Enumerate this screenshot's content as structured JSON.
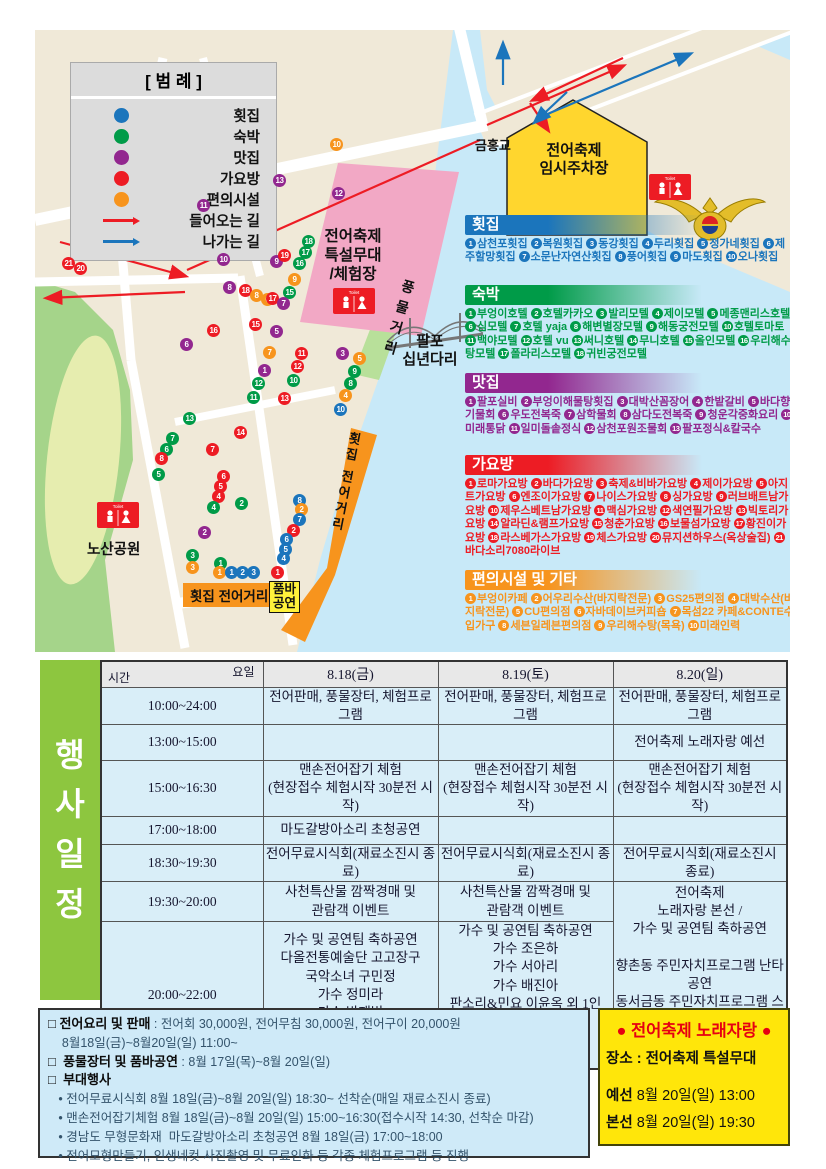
{
  "legend": {
    "title": "[ 범 례 ]",
    "items": [
      {
        "label": "횟집",
        "color": "#1b75bc"
      },
      {
        "label": "숙박",
        "color": "#009b48"
      },
      {
        "label": "맛집",
        "color": "#92278f"
      },
      {
        "label": "가요방",
        "color": "#ed1c24"
      },
      {
        "label": "편의시설",
        "color": "#f7941d"
      }
    ],
    "arrows": [
      {
        "label": "들어오는 길",
        "color": "#ed1c24"
      },
      {
        "label": "나가는 길",
        "color": "#1b75bc"
      }
    ]
  },
  "map": {
    "labels": {
      "bridge_top": "금홍교",
      "parking": "전어축제\n임시주차장",
      "stage": "전어축제\n특설무대\n/체험장",
      "pungmul": "풍물거리",
      "bridge": "팔포\n십년다리",
      "park": "노산공원",
      "fish_street": "횟집 전어거리",
      "fish_street_v": "횟집 전어거리",
      "pumba": "품바\n공연",
      "toilet": "Toilet"
    },
    "dots": [
      {
        "c": "r",
        "n": 21,
        "x": 27,
        "y": 227
      },
      {
        "c": "r",
        "n": 20,
        "x": 39,
        "y": 232
      },
      {
        "c": "p",
        "n": 13,
        "x": 238,
        "y": 144
      },
      {
        "c": "o",
        "n": 10,
        "x": 295,
        "y": 108
      },
      {
        "c": "p",
        "n": 12,
        "x": 297,
        "y": 157
      },
      {
        "c": "p",
        "n": 11,
        "x": 162,
        "y": 169
      },
      {
        "c": "p",
        "n": 10,
        "x": 182,
        "y": 223
      },
      {
        "c": "p",
        "n": 9,
        "x": 235,
        "y": 225
      },
      {
        "c": "r",
        "n": 19,
        "x": 243,
        "y": 219
      },
      {
        "c": "g",
        "n": 18,
        "x": 267,
        "y": 205
      },
      {
        "c": "g",
        "n": 17,
        "x": 264,
        "y": 216
      },
      {
        "c": "g",
        "n": 16,
        "x": 258,
        "y": 227
      },
      {
        "c": "o",
        "n": 9,
        "x": 253,
        "y": 243
      },
      {
        "c": "p",
        "n": 8,
        "x": 188,
        "y": 251
      },
      {
        "c": "r",
        "n": 18,
        "x": 204,
        "y": 254
      },
      {
        "c": "o",
        "n": 8,
        "x": 215,
        "y": 259
      },
      {
        "c": "o",
        "n": 6,
        "x": 226,
        "y": 263
      },
      {
        "c": "g",
        "n": 15,
        "x": 248,
        "y": 256
      },
      {
        "c": "r",
        "n": 17,
        "x": 231,
        "y": 262
      },
      {
        "c": "p",
        "n": 7,
        "x": 242,
        "y": 267
      },
      {
        "c": "r",
        "n": 16,
        "x": 172,
        "y": 294
      },
      {
        "c": "r",
        "n": 15,
        "x": 214,
        "y": 288
      },
      {
        "c": "p",
        "n": 5,
        "x": 235,
        "y": 295
      },
      {
        "c": "o",
        "n": 7,
        "x": 228,
        "y": 316
      },
      {
        "c": "p",
        "n": 6,
        "x": 145,
        "y": 308
      },
      {
        "c": "r",
        "n": 11,
        "x": 260,
        "y": 317
      },
      {
        "c": "r",
        "n": 12,
        "x": 256,
        "y": 330
      },
      {
        "c": "p",
        "n": 1,
        "x": 223,
        "y": 334
      },
      {
        "c": "g",
        "n": 12,
        "x": 217,
        "y": 347
      },
      {
        "c": "g",
        "n": 10,
        "x": 252,
        "y": 344
      },
      {
        "c": "g",
        "n": 11,
        "x": 212,
        "y": 361
      },
      {
        "c": "r",
        "n": 13,
        "x": 243,
        "y": 362
      },
      {
        "c": "g",
        "n": 13,
        "x": 148,
        "y": 382
      },
      {
        "c": "r",
        "n": 14,
        "x": 199,
        "y": 396
      },
      {
        "c": "g",
        "n": 7,
        "x": 131,
        "y": 402
      },
      {
        "c": "g",
        "n": 6,
        "x": 125,
        "y": 413
      },
      {
        "c": "r",
        "n": 8,
        "x": 120,
        "y": 422
      },
      {
        "c": "r",
        "n": 7,
        "x": 171,
        "y": 413
      },
      {
        "c": "g",
        "n": 5,
        "x": 117,
        "y": 438
      },
      {
        "c": "r",
        "n": 6,
        "x": 182,
        "y": 440
      },
      {
        "c": "r",
        "n": 5,
        "x": 179,
        "y": 450
      },
      {
        "c": "r",
        "n": 4,
        "x": 177,
        "y": 460
      },
      {
        "c": "g",
        "n": 4,
        "x": 172,
        "y": 471
      },
      {
        "c": "p",
        "n": 2,
        "x": 163,
        "y": 496
      },
      {
        "c": "g",
        "n": 3,
        "x": 151,
        "y": 519
      },
      {
        "c": "p",
        "n": 3,
        "x": 301,
        "y": 317
      },
      {
        "c": "o",
        "n": 5,
        "x": 318,
        "y": 322
      },
      {
        "c": "g",
        "n": 9,
        "x": 313,
        "y": 335
      },
      {
        "c": "g",
        "n": 8,
        "x": 309,
        "y": 347
      },
      {
        "c": "o",
        "n": 4,
        "x": 304,
        "y": 359
      },
      {
        "c": "b",
        "n": 10,
        "x": 299,
        "y": 373
      },
      {
        "c": "g",
        "n": 2,
        "x": 200,
        "y": 467
      },
      {
        "c": "b",
        "n": 8,
        "x": 258,
        "y": 464
      },
      {
        "c": "o",
        "n": 2,
        "x": 260,
        "y": 473
      },
      {
        "c": "b",
        "n": 7,
        "x": 258,
        "y": 483
      },
      {
        "c": "r",
        "n": 2,
        "x": 252,
        "y": 494
      },
      {
        "c": "b",
        "n": 6,
        "x": 245,
        "y": 503
      },
      {
        "c": "b",
        "n": 5,
        "x": 244,
        "y": 513
      },
      {
        "c": "b",
        "n": 4,
        "x": 242,
        "y": 522
      },
      {
        "c": "o",
        "n": 3,
        "x": 151,
        "y": 531
      },
      {
        "c": "g",
        "n": 1,
        "x": 179,
        "y": 527
      },
      {
        "c": "o",
        "n": 1,
        "x": 178,
        "y": 536
      },
      {
        "c": "b",
        "n": 1,
        "x": 190,
        "y": 536
      },
      {
        "c": "b",
        "n": 2,
        "x": 201,
        "y": 536
      },
      {
        "c": "b",
        "n": 3,
        "x": 212,
        "y": 536
      },
      {
        "c": "r",
        "n": 1,
        "x": 236,
        "y": 536
      }
    ]
  },
  "directory": {
    "sections": [
      {
        "key": "hoejip",
        "title": "횟집",
        "color": "#1b75bc",
        "items": [
          "삼천포횟집",
          "복원횟집",
          "동강횟집",
          "두리횟집",
          "정가네횟집",
          "제주할망횟집",
          "소문난자연산횟집",
          "풍어횟집",
          "마도횟집",
          "오나횟집"
        ]
      },
      {
        "key": "sukbak",
        "title": "숙박",
        "color": "#009b48",
        "items": [
          "부엉이호텔",
          "호텔카카오",
          "발리모텔",
          "제이모텔",
          "메종맨리스호텔",
          "심모텔",
          "호텔 yaja",
          "해변별장모텔",
          "해동궁전모텔",
          "호텔토마토",
          "백야모텔",
          "호텔 vu",
          "써니호텔",
          "무니호텔",
          "올인모텔",
          "우리해수탕모텔",
          "폴라리스모텔",
          "귀빈궁전모텔"
        ]
      },
      {
        "key": "matjip",
        "title": "맛집",
        "color": "#92278f",
        "items": [
          "팔포실비",
          "부엉이해물탕횟집",
          "대박산꼼장어",
          "한밭갈비",
          "바다향기물회",
          "우도전복죽",
          "삼학물회",
          "삼다도전복죽",
          "청운각중화요리",
          "미래통닭",
          "일미돌솥정식",
          "삼천포원조물회",
          "팔포정식&칼국수"
        ]
      },
      {
        "key": "gayobang",
        "title": "가요방",
        "color": "#ed1c24",
        "items": [
          "로마가요방",
          "바다가요방",
          "축제&비바가요방",
          "제이가요방",
          "아지트가요방",
          "엔조이가요방",
          "나이스가요방",
          "싱가요방",
          "러브배트남가요방",
          "제우스베트남가요방",
          "맥심가요방",
          "색연필가요방",
          "빅토리가요방",
          "알라딘&램프가요방",
          "청춘가요방",
          "보물섬가요방",
          "황진이가요방",
          "라스베가스가요방",
          "체스가요방",
          "뮤지션하우스(옥상술집)",
          "바다소리7080라이브"
        ]
      },
      {
        "key": "pyeonui",
        "title": "편의시설 및 기타",
        "color": "#f7941d",
        "items": [
          "부엉이카페",
          "어우리수산(바지락전문)",
          "GS25편의점",
          "대박수산(바지락전문)",
          "CU편의점",
          "자바데이브커피숍",
          "목섬22 카페&CONTE수입가구",
          "세븐일레븐편의점",
          "우리해수탕(목욕)",
          "미래인력"
        ]
      }
    ]
  },
  "schedule": {
    "side_label": "행\n사\n일\n정",
    "corner_day": "요일",
    "corner_time": "시간",
    "days": [
      "8.18(금)",
      "8.19(토)",
      "8.20(일)"
    ],
    "rows": [
      {
        "time": "10:00~24:00",
        "fri": "전어판매, 풍물장터, 체험프로그램",
        "sat": "전어판매, 풍물장터, 체험프로그램",
        "sun": "전어판매, 풍물장터, 체험프로그램"
      },
      {
        "time": "13:00~15:00",
        "fri": "",
        "sat": "",
        "sun": "전어축제 노래자랑 예선"
      },
      {
        "time": "15:00~16:30",
        "fri": "맨손전어잡기 체험\n(현장접수 체험시작 30분전 시작)",
        "sat": "맨손전어잡기 체험\n(현장접수 체험시작 30분전 시작)",
        "sun": "맨손전어잡기 체험\n(현장접수 체험시작 30분전 시작)"
      },
      {
        "time": "17:00~18:00",
        "fri": "마도갈방아소리 초청공연",
        "sat": "",
        "sun": ""
      },
      {
        "time": "18:30~19:30",
        "fri": "전어무료시식회(재료소진시 종료)",
        "sat": "전어무료시식회(재료소진시 종료)",
        "sun": "전어무료시식회(재료소진시 종료)"
      },
      {
        "time": "19:30~20:00",
        "fri": "사천특산물 깜짝경매 및\n관람객 이벤트",
        "sat": "사천특산물 깜짝경매 및\n관람객 이벤트",
        "sun": "전어축제\n노래자랑 본선 /\n가수 및 공연팀 축하공연\n\n향촌동 주민자치프로그램 난타공연\n동서금동 주민자치프로그램 스포츠댄스\n가수 백프로\n댄스팀 레트로"
      },
      {
        "time": "20:00~22:00",
        "fri": "가수 및 공연팀 축하공연\n다올전통예술단 고고장구\n국악소녀 구민정\n가수 정미라\n가수 박재범\n가수 한별이\n품바여신 버드리",
        "sat": "가수 및 공연팀 축하공연\n가수 조은하\n가수 서아리\n가수 배진아\n판소리&민요 이윤옥 외 1인\n가수 문수화\n가수 김혜진\n가수 유진표"
      }
    ]
  },
  "info": {
    "lines": [
      {
        "h": "□ 전어요리 및 판매",
        "t": " : 전어회 30,000원, 전어무침 30,000원, 전어구이 20,000원"
      },
      {
        "h": "",
        "t": "    8월18일(금)~8월20일(일) 11:00~"
      },
      {
        "h": "□  풍물장터 및 품바공연",
        "t": " : 8월 17일(목)~8월 20일(일)"
      },
      {
        "h": "□  부대행사",
        "t": ""
      },
      {
        "h": "",
        "t": "   • 전어무료시식회 8월 18일(금)~8월 20일(일) 18:30~ 선착순(매일 재료소진시 종료)"
      },
      {
        "h": "",
        "t": "   • 맨손전어잡기체험 8월 18일(금)~8월 20일(일) 15:00~16:30(접수시작 14:30, 선착순 마감)"
      },
      {
        "h": "",
        "t": "   • 경남도 무형문화재  마도갈방아소리 초청공연 8월 18일(금) 17:00~18:00"
      },
      {
        "h": "",
        "t": "   • 전어모형만들기, 인생네컷 사진촬영 및 무료인화 등 각종 체험프로그램 등 진행"
      }
    ]
  },
  "contest": {
    "title": "● 전어축제 노래자랑 ●",
    "place": "장소 : 전어축제 특설무대",
    "rounds": [
      {
        "label": "예선",
        "value": "8월 20일(일) 13:00"
      },
      {
        "label": "본선",
        "value": "8월 20일(일) 19:30"
      }
    ],
    "accent": "#e60012",
    "bg": "#ffe60a"
  }
}
